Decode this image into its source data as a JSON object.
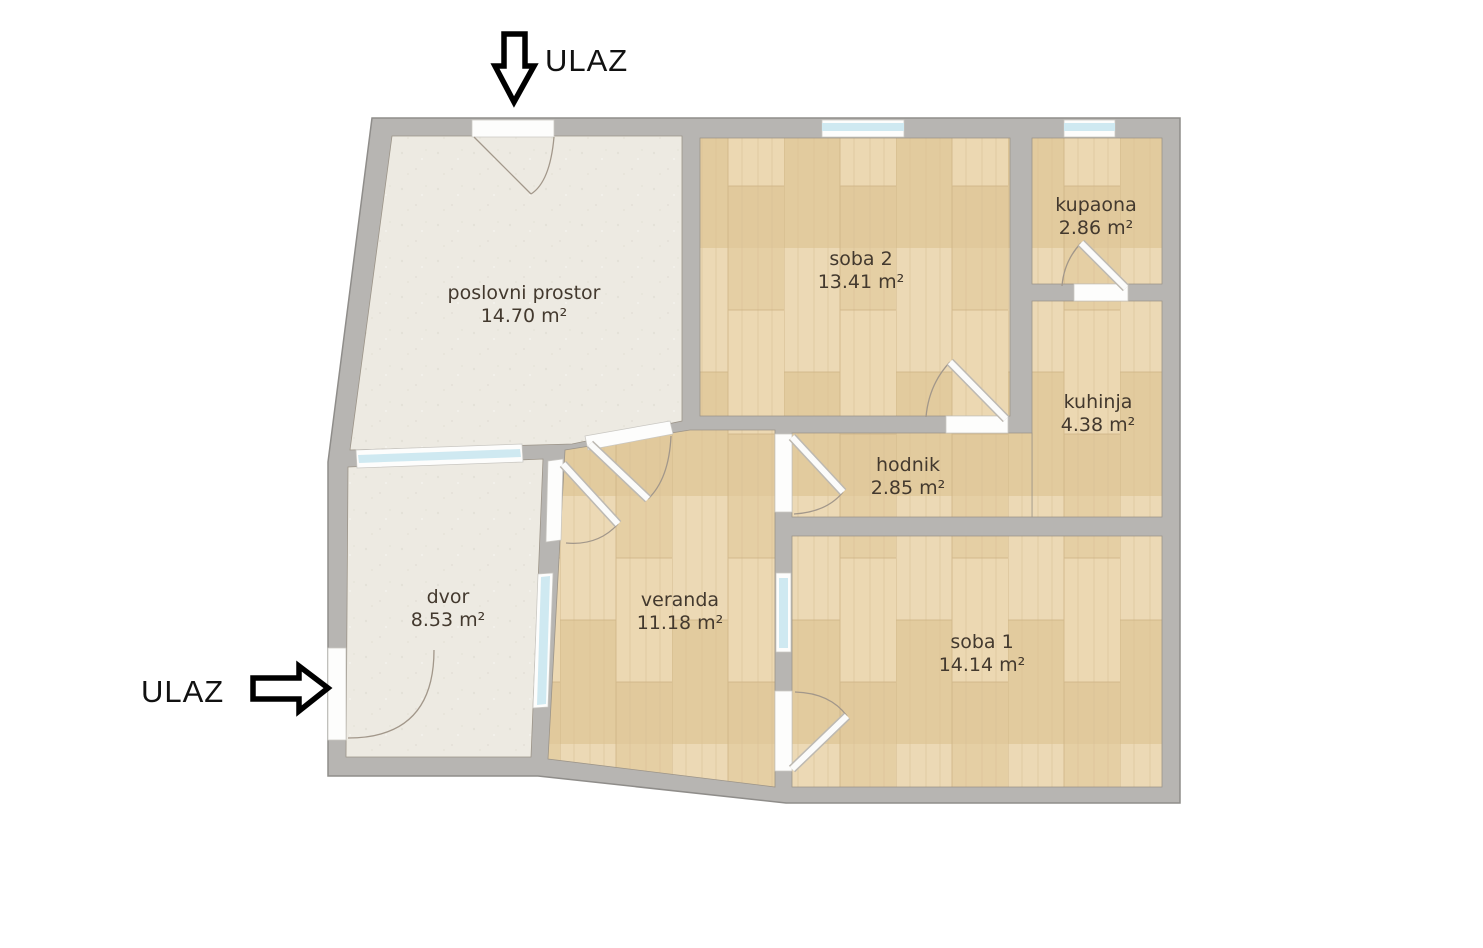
{
  "entrances": [
    {
      "label": "ULAZ",
      "position": "top",
      "arrow": "arrow-down-icon"
    },
    {
      "label": "ULAZ",
      "position": "left",
      "arrow": "arrow-right-icon"
    }
  ],
  "rooms": [
    {
      "id": "poslovni-prostor",
      "name": "poslovni prostor",
      "area": "14.70 m²",
      "floor": "plaster"
    },
    {
      "id": "soba-2",
      "name": "soba 2",
      "area": "13.41 m²",
      "floor": "wood"
    },
    {
      "id": "kupaona",
      "name": "kupaona",
      "area": "2.86 m²",
      "floor": "wood"
    },
    {
      "id": "kuhinja",
      "name": "kuhinja",
      "area": "4.38 m²",
      "floor": "wood"
    },
    {
      "id": "hodnik",
      "name": "hodnik",
      "area": "2.85 m²",
      "floor": "wood"
    },
    {
      "id": "dvor",
      "name": "dvor",
      "area": "8.53 m²",
      "floor": "plaster"
    },
    {
      "id": "veranda",
      "name": "veranda",
      "area": "11.18 m²",
      "floor": "wood"
    },
    {
      "id": "soba-1",
      "name": "soba 1",
      "area": "14.14 m²",
      "floor": "wood"
    }
  ],
  "colors": {
    "wall": "#b7b5b2",
    "wall_edge": "#8f8d8a",
    "wood_floor": "#e8d3ab",
    "plaster_floor": "#edeae2",
    "window_glass": "#cfe9f1",
    "door": "#fdfdfc",
    "label_text": "#43392e",
    "entrance_text": "#111111"
  }
}
